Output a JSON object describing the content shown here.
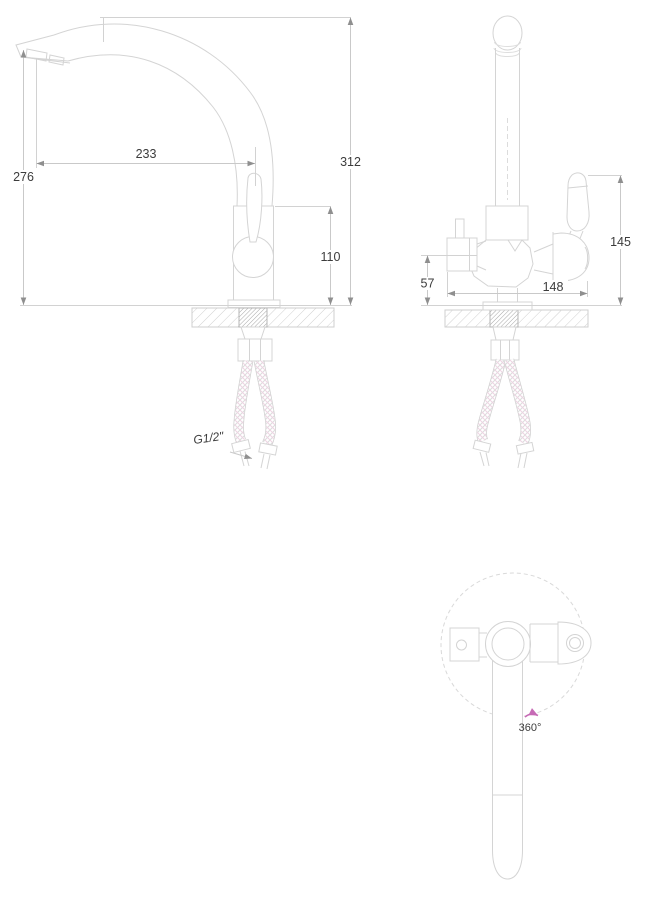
{
  "drawing": {
    "type": "kitchen-faucet-installation-drawing",
    "views": {
      "front_view": "faucet side profile with gooseneck spout",
      "side_view": "faucet front profile with filter valve and lever",
      "top_view": "spout rotation diagram"
    }
  },
  "dimensions": {
    "front_view": {
      "spout_reach": "233",
      "overall_height": "312",
      "spout_outlet_height": "276",
      "body_height": "110"
    },
    "side_view": {
      "lever_height": "145",
      "filter_outlet_height": "57",
      "overall_width": "148"
    },
    "connection": {
      "thread_label": "G1/2\""
    },
    "top_view": {
      "rotation_label": "360°"
    }
  },
  "colors": {
    "background": "#ffffff",
    "outline": "#d4d4d4",
    "dimension_line": "#c9c9c9",
    "arrow": "#8f8f8f",
    "text": "#3c3c3c",
    "hatch": "#d0d0d0",
    "thread_hatch": "#a6a6a6",
    "braid": "#dcdcdc",
    "braid_tint": "#eed3e2",
    "rotation_arrow": "#c66ab5"
  }
}
